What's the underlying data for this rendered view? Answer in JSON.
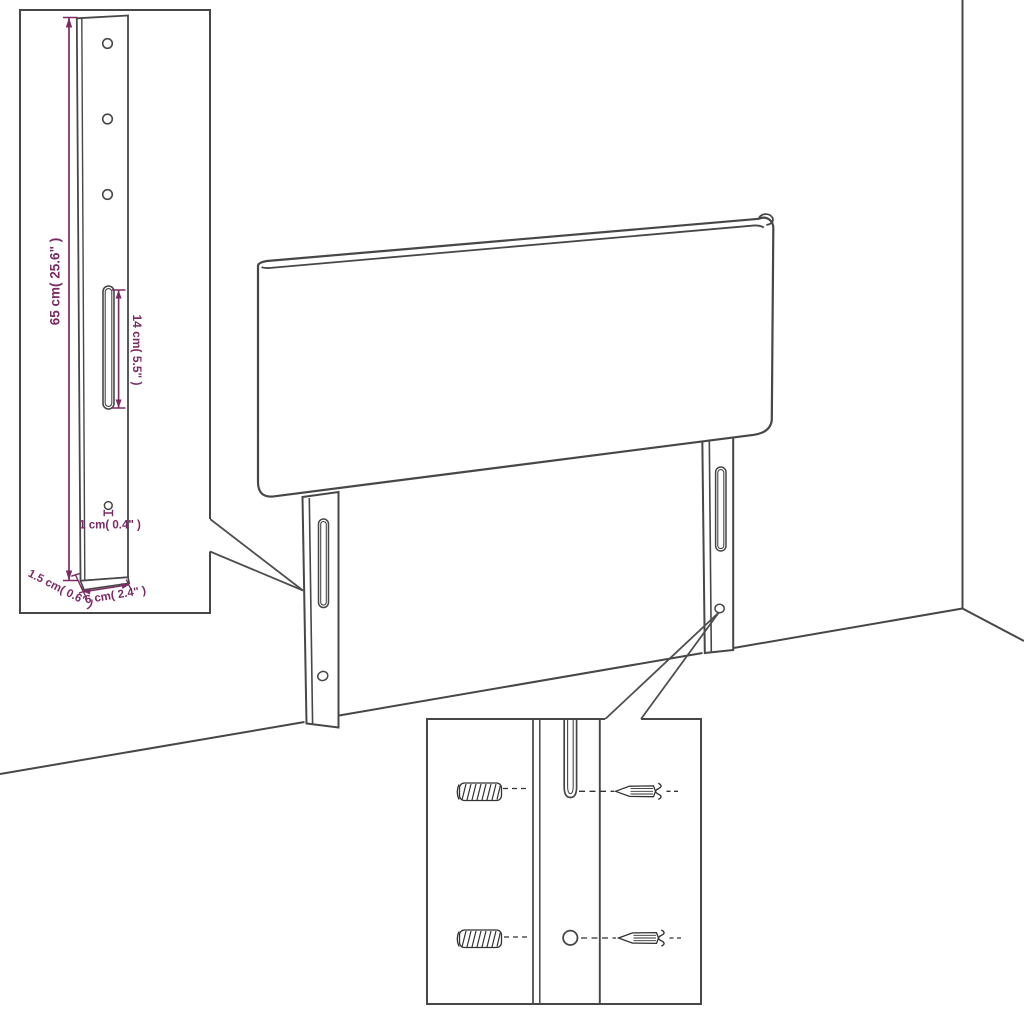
{
  "diagram": {
    "type": "furniture-dimension-diagram",
    "subject": "upholstered headboard with two slotted mounting legs shown in a room corner, with a magnified leg view and a wall-mounting hardware close-up",
    "colors": {
      "outline": "#474747",
      "hardware_ink": "#323232",
      "dimension": "#7b2b64",
      "background": "#ffffff"
    },
    "insets": {
      "leg_detail": {
        "name": "enlarged-leg-front-view",
        "labels": {
          "leg_height": "65 cm( 25.6\" )",
          "slot_length": "14 cm( 5.5\" )",
          "hole_diameter": "1 cm( 0.4\" )",
          "leg_thickness": "1.5 cm( 0.6\" )",
          "leg_width": "6 cm( 2.4\" )"
        }
      },
      "mounting_detail": {
        "name": "wall-mounting-hardware-close-up",
        "hardware": [
          "wall-plug",
          "screw"
        ]
      }
    }
  }
}
